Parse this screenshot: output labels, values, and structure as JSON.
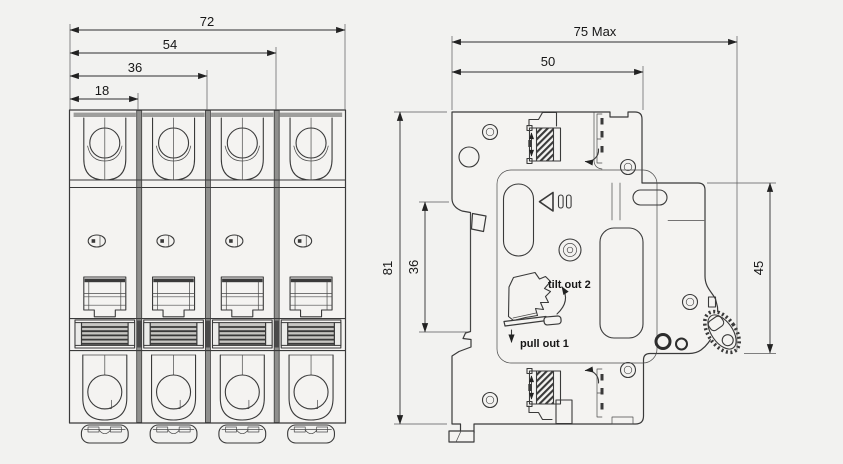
{
  "front_view": {
    "dims": {
      "overall": "72",
      "three_pole": "54",
      "two_pole": "36",
      "one_pole": "18"
    }
  },
  "side_view": {
    "dims": {
      "depth_max": "75 Max",
      "upper_depth": "50",
      "height": "81",
      "rail_recess": "36",
      "front_face": "45"
    },
    "annotations": {
      "step2": "tilt out 2",
      "step1": "pull out 1"
    }
  },
  "colors": {
    "background": "#f2f2f0",
    "line": "#3a3a3a",
    "dark_fill": "#8f8f8d",
    "stripe_fill": "#c6c5c2"
  }
}
